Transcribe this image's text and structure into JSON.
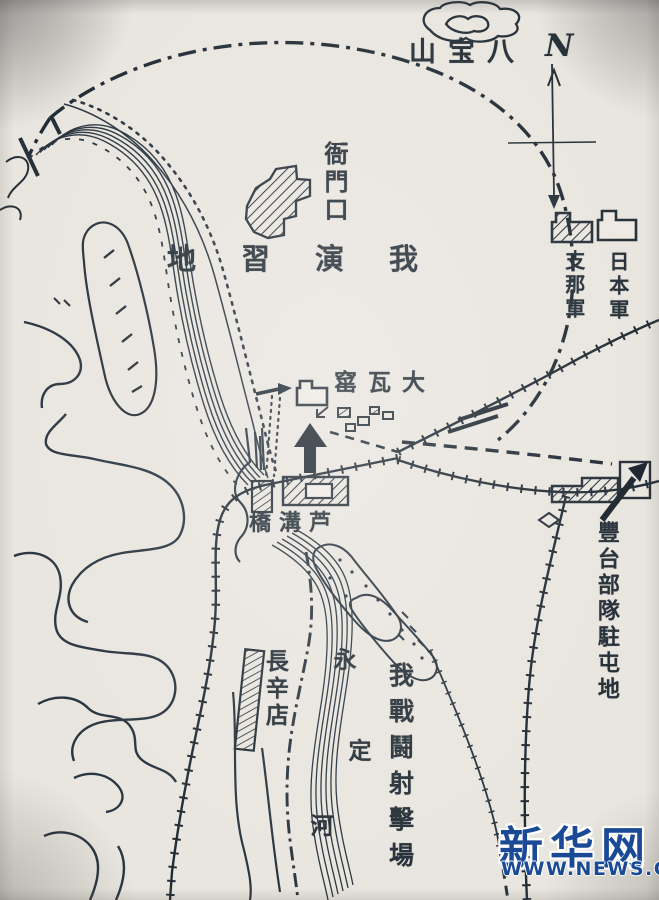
{
  "map": {
    "compass_north": "N",
    "babaoshan_label": "山宝八",
    "yamenkou_label": "衙門口",
    "drill_ground_label": "地習演我",
    "dawayao_label": "窰瓦大",
    "lugouqiao_label": "橋溝芦",
    "changxindian_label": "長辛店",
    "yongding_river_chars": [
      "永",
      "定",
      "河"
    ],
    "firing_range_label": "我戰鬪射擊場",
    "fengtai_label": "豐台部隊駐屯地",
    "legend": {
      "chinese_army": "支那軍",
      "japanese_army": "日本軍"
    },
    "ink_color": "#273139",
    "paper_color": "#e9e5df"
  },
  "watermark": {
    "brand": "新华网",
    "url": "WWW.NEWS.CN",
    "brand_color": "#1a4a96"
  }
}
